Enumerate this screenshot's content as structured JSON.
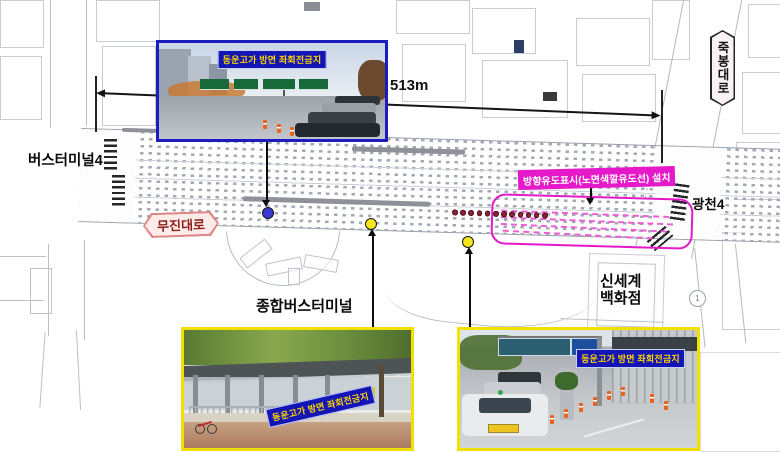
{
  "map": {
    "dimension": {
      "label": "513m"
    },
    "labels": {
      "bus_terminal_4": "버스터미널4",
      "mujin_daero": "무진대로",
      "jukbong_daero": "죽봉대로",
      "gwangcheon_4": "광천4",
      "general_bus_terminal": "종합버스터미널",
      "shinsegae_dept": "신세계\n백화점",
      "map_point_1": "1"
    },
    "guidance": {
      "label": "방향유도표시(노면색깔유도선) 설치"
    }
  },
  "insets": {
    "top": {
      "caption": "동운고가 방면 좌회전금지"
    },
    "bottom_left": {
      "caption": "동운고가 방면 좌회전금지"
    },
    "bottom_right": {
      "caption": "동운고가 방면 좌회전금지"
    }
  },
  "colors": {
    "caption-bg": "#1316b4",
    "caption-text": "#ffd400",
    "inset-border-blue": "#1d1dbe",
    "inset-border-yellow": "#f2e000",
    "guidance-magenta": "#e519c9",
    "marker-blue": "#3a3ad0",
    "marker-yellow": "#f2e71d",
    "marker-maroon": "#8c2332",
    "callout-red": "#8c1d18"
  }
}
